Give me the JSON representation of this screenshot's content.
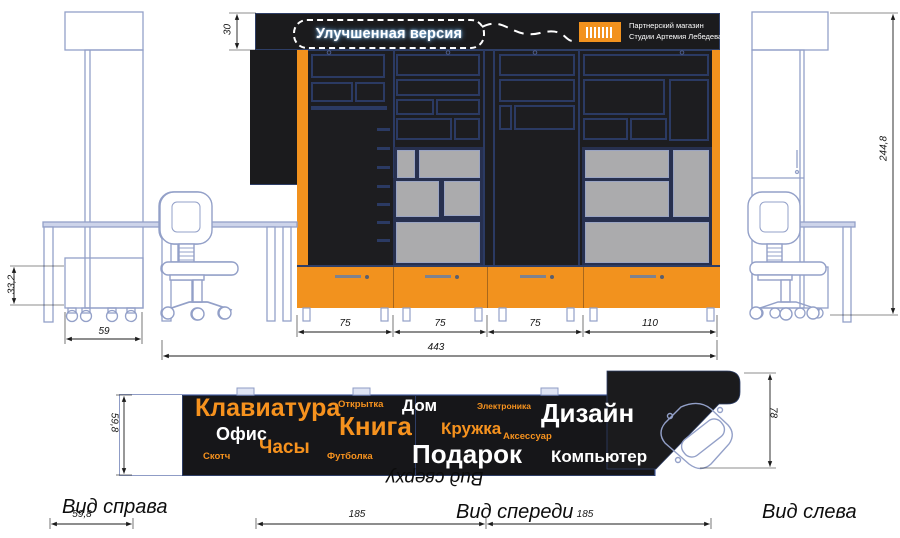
{
  "header": {
    "balloon_label": "Улучшенная версия",
    "logo_icon": "barcode-logo",
    "partner_line1": "Партнерский магазин",
    "partner_line2": "Студии Артемия Лебедева"
  },
  "view_labels": {
    "right": "Вид справа",
    "front": "Вид спереди",
    "left": "Вид слева",
    "top": "Вид сверху"
  },
  "dimensions": {
    "header_height": "30",
    "base_height": "33,2",
    "side_width": "59",
    "section_1": "75",
    "section_2": "75",
    "section_3": "75",
    "section_4": "110",
    "total_width": "443",
    "total_height": "244,8",
    "top_depth": "59,8",
    "counter_depth": "78",
    "front_left_depth": "185",
    "front_right_depth": "185",
    "right_view_depth": "59,8"
  },
  "top_view_words": [
    {
      "text": "Клавиатура",
      "color": "#f6921e"
    },
    {
      "text": "Открытка",
      "color": "#f6921e"
    },
    {
      "text": "Дом",
      "color": "#ffffff"
    },
    {
      "text": "Электроника",
      "color": "#f6921e"
    },
    {
      "text": "Дизайн",
      "color": "#ffffff"
    },
    {
      "text": "Офис",
      "color": "#ffffff"
    },
    {
      "text": "Книга",
      "color": "#f6921e"
    },
    {
      "text": "Кружка",
      "color": "#f6921e"
    },
    {
      "text": "Аксессуар",
      "color": "#f6921e"
    },
    {
      "text": "Часы",
      "color": "#f6921e"
    },
    {
      "text": "Скотч",
      "color": "#f6921e"
    },
    {
      "text": "Футболка",
      "color": "#f6921e"
    },
    {
      "text": "Подарок",
      "color": "#ffffff"
    },
    {
      "text": "Компьютер",
      "color": "#ffffff"
    }
  ],
  "colors": {
    "accent_orange": "#f2921e",
    "panel_black": "#1c1c1f",
    "shelf_navy": "#2b3a63",
    "shelf_gray": "#ababad",
    "blueprint_line": "#93a0c8"
  }
}
